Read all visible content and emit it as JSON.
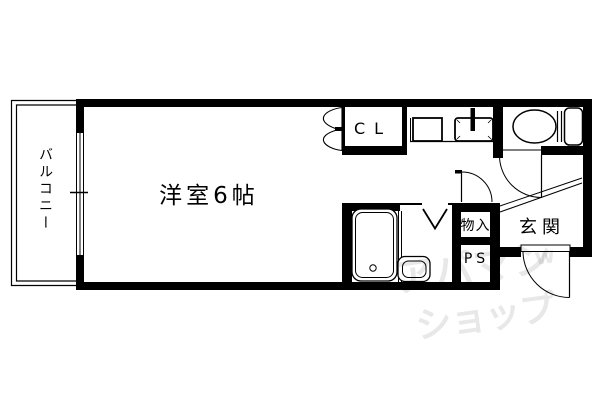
{
  "floorplan": {
    "background": "#ffffff",
    "line_color": "#000000",
    "rooms": {
      "main_room": "洋室6帖",
      "balcony": "バルコニー",
      "closet": "CL",
      "storage": "物入",
      "pipe_space": "PS",
      "entrance": "玄関"
    },
    "watermark": {
      "line1": "アパマン",
      "line2": "ショップ",
      "mark": "w",
      "color": "#e8e8e8"
    }
  }
}
